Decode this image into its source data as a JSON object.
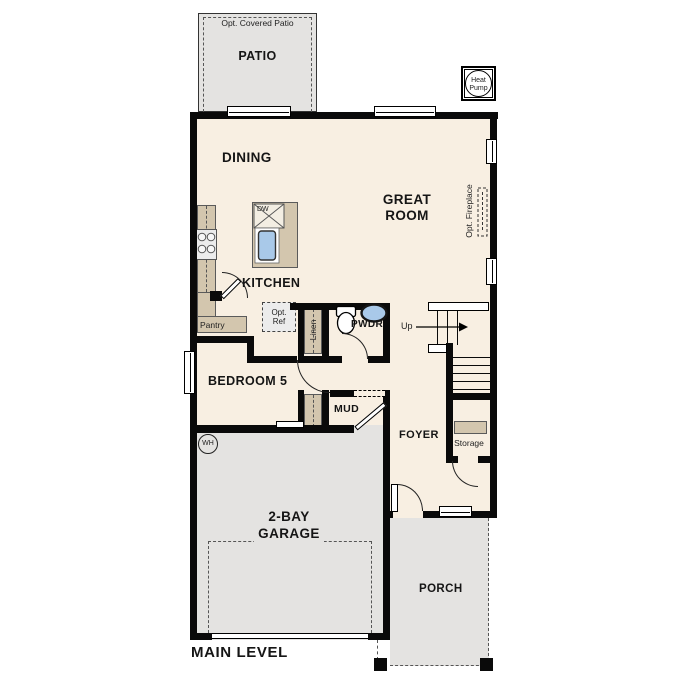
{
  "title": {
    "main_level": "MAIN LEVEL"
  },
  "rooms": {
    "patio": {
      "label": "PATIO",
      "note": "Opt. Covered Patio"
    },
    "dining": {
      "label": "DINING"
    },
    "great_room": {
      "line1": "GREAT",
      "line2": "ROOM"
    },
    "kitchen": {
      "label": "KITCHEN"
    },
    "pantry": {
      "label": "Pantry"
    },
    "linen": {
      "label": "Linen"
    },
    "powder": {
      "label": "PWDR"
    },
    "bedroom5": {
      "label": "BEDROOM 5"
    },
    "mud": {
      "label": "MUD"
    },
    "foyer": {
      "label": "FOYER"
    },
    "storage": {
      "label": "Storage"
    },
    "garage": {
      "line1": "2-BAY",
      "line2": "GARAGE"
    },
    "porch": {
      "label": "PORCH"
    }
  },
  "fixtures": {
    "heat_pump": {
      "line1": "Heat",
      "line2": "Pump"
    },
    "dishwasher": {
      "label": "DW"
    },
    "opt_ref": {
      "line1": "Opt.",
      "line2": "Ref"
    },
    "opt_fireplace": {
      "label": "Opt. Fireplace"
    },
    "water_heater": {
      "label": "WH"
    },
    "stairs": {
      "direction": "Up"
    }
  },
  "colors": {
    "wall": "#0a0a0a",
    "floor": "#f8efe2",
    "concrete": "#e4e3e1",
    "counter": "#d3c6ae",
    "fixture_blue": "#a9c9e9"
  }
}
